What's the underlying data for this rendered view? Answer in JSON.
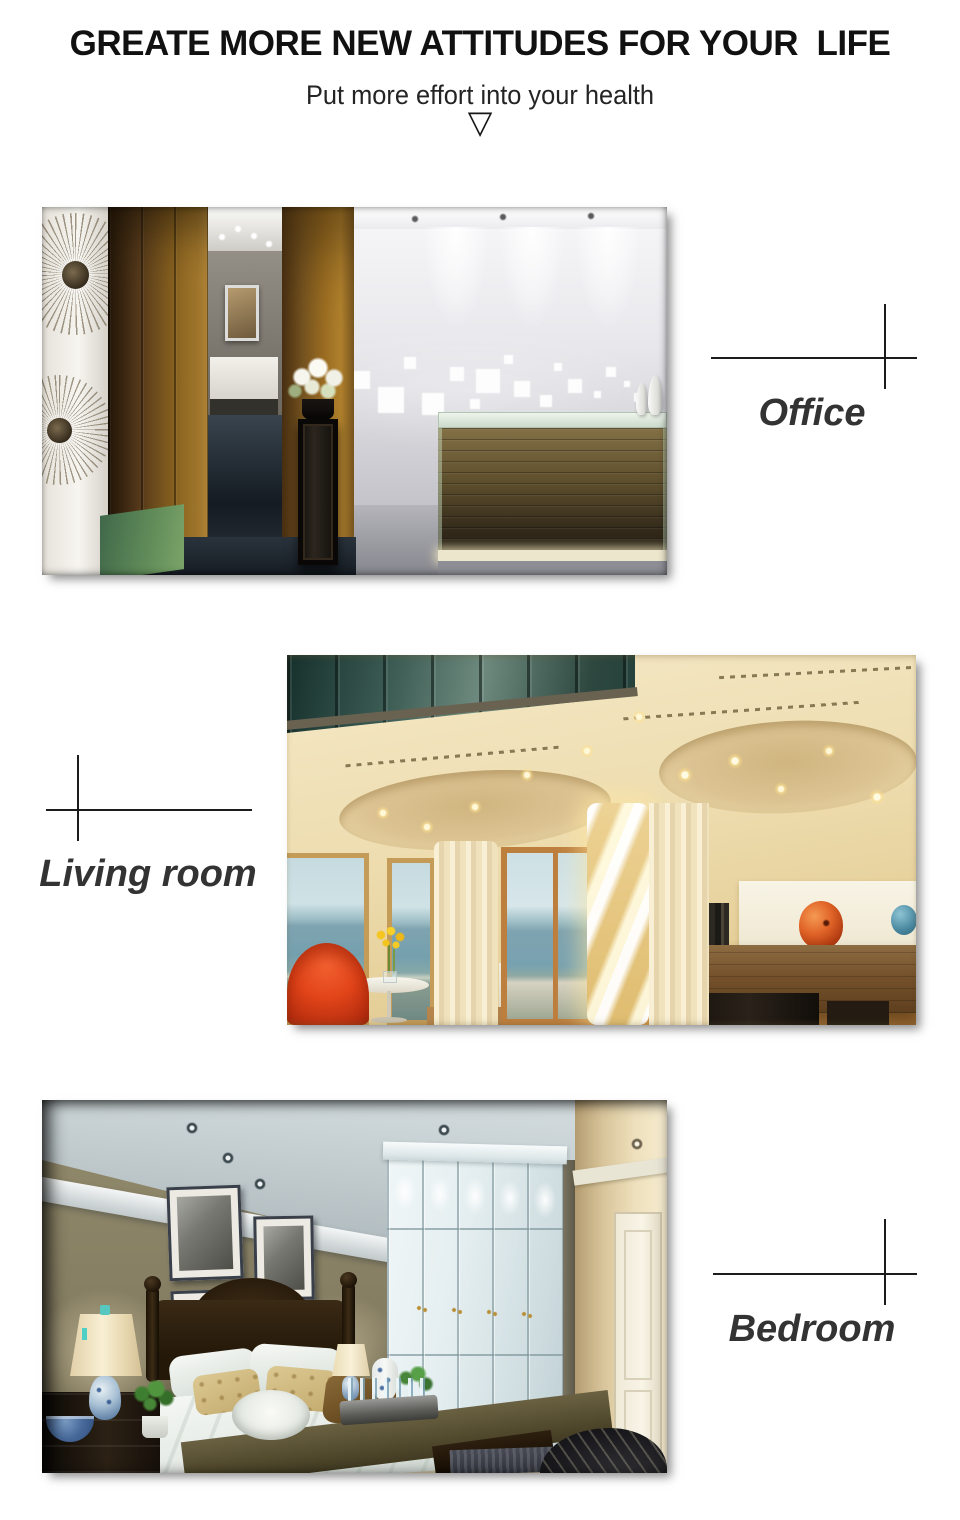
{
  "header": {
    "title": "GREATE MORE NEW ATTITUDES FOR YOUR  LIFE",
    "subtitle": "Put more effort into your health",
    "arrow_glyph": "▽"
  },
  "sections": [
    {
      "id": "office",
      "label": "Office"
    },
    {
      "id": "living-room",
      "label": "Living room"
    },
    {
      "id": "bedroom",
      "label": "Bedroom"
    }
  ],
  "colors": {
    "page_background": "#ffffff",
    "title_text": "#111111",
    "subtitle_text": "#242424",
    "label_text": "#333333",
    "crosshair_line": "#1c1c1c"
  }
}
